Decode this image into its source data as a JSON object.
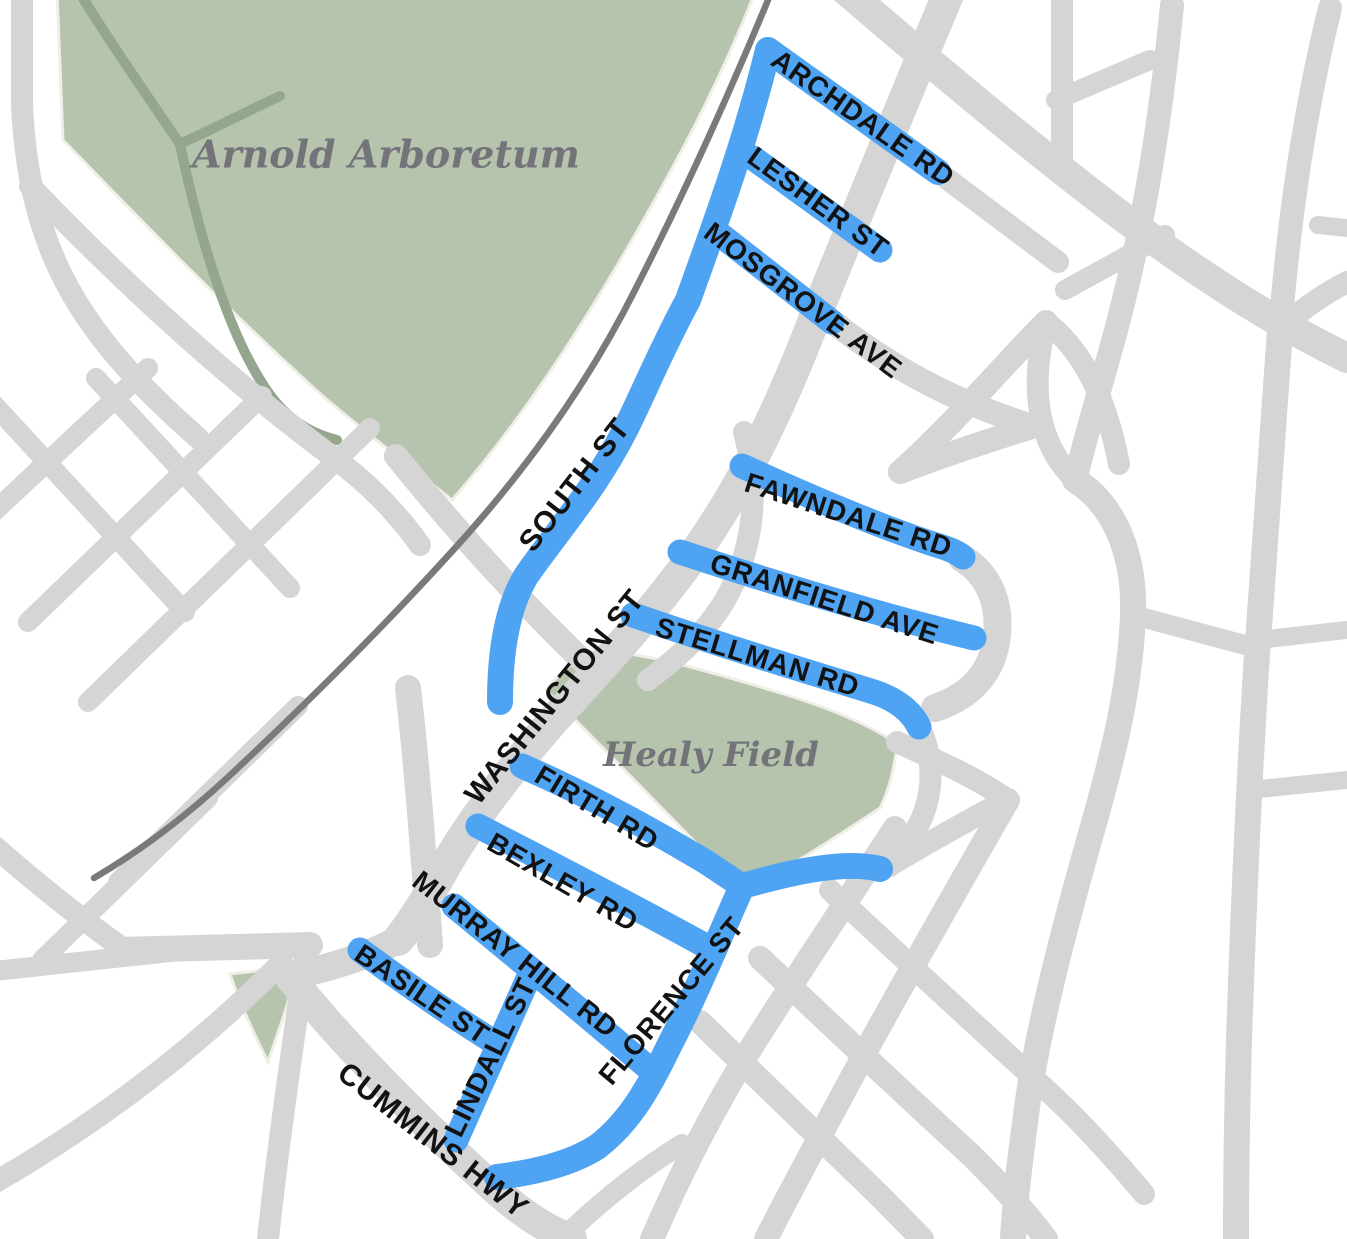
{
  "map": {
    "title": "Neighborhood street map with highlighted streets",
    "region_labels": {
      "arboretum": "Arnold Arboretum",
      "field": "Healy Field"
    },
    "highlighted_streets": [
      {
        "label": "ARCHDALE RD"
      },
      {
        "label": "LESHER ST"
      },
      {
        "label": "MOSGROVE AVE"
      },
      {
        "label": "SOUTH ST"
      },
      {
        "label": "FAWNDALE RD"
      },
      {
        "label": "GRANFIELD AVE"
      },
      {
        "label": "STELLMAN RD"
      },
      {
        "label": "FIRTH RD"
      },
      {
        "label": "BEXLEY RD"
      },
      {
        "label": "MURRAY HILL RD"
      },
      {
        "label": "BASILE ST"
      },
      {
        "label": "LINDALL ST"
      },
      {
        "label": "FLORENCE ST"
      }
    ],
    "other_streets": [
      {
        "label": "WASHINGTON ST"
      },
      {
        "label": "CUMMINS HWY"
      }
    ],
    "colors": {
      "highlight": "#4ea3f2",
      "road": "#d5d5d5",
      "rail": "#7a7a7a",
      "park": "#b6c3ad",
      "parkoutline": "#f0efe7",
      "parkpath": "#94a68e",
      "label": "#121212",
      "park_label": "#73737a",
      "background": "#ffffff"
    }
  }
}
